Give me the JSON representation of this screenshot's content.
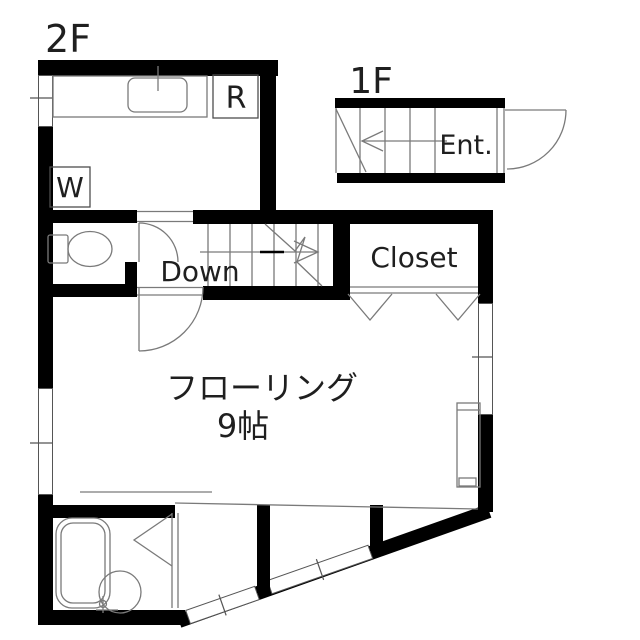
{
  "title": "Apartment floor plan",
  "floors": {
    "f2": {
      "label": "2F"
    },
    "f1": {
      "label": "1F"
    }
  },
  "rooms": {
    "refrigerator": "R",
    "washer": "W",
    "stairs_down": "Down",
    "entrance": "Ent.",
    "closet": "Closet",
    "main_room_name": "フローリング",
    "main_room_size": "9帖"
  },
  "colors": {
    "wall": "#000000",
    "fixture": "#7a7a7a",
    "fixture_dark": "#4d4d4d",
    "frame": "#555555",
    "text": "#1f1f1f",
    "background": "#ffffff"
  }
}
